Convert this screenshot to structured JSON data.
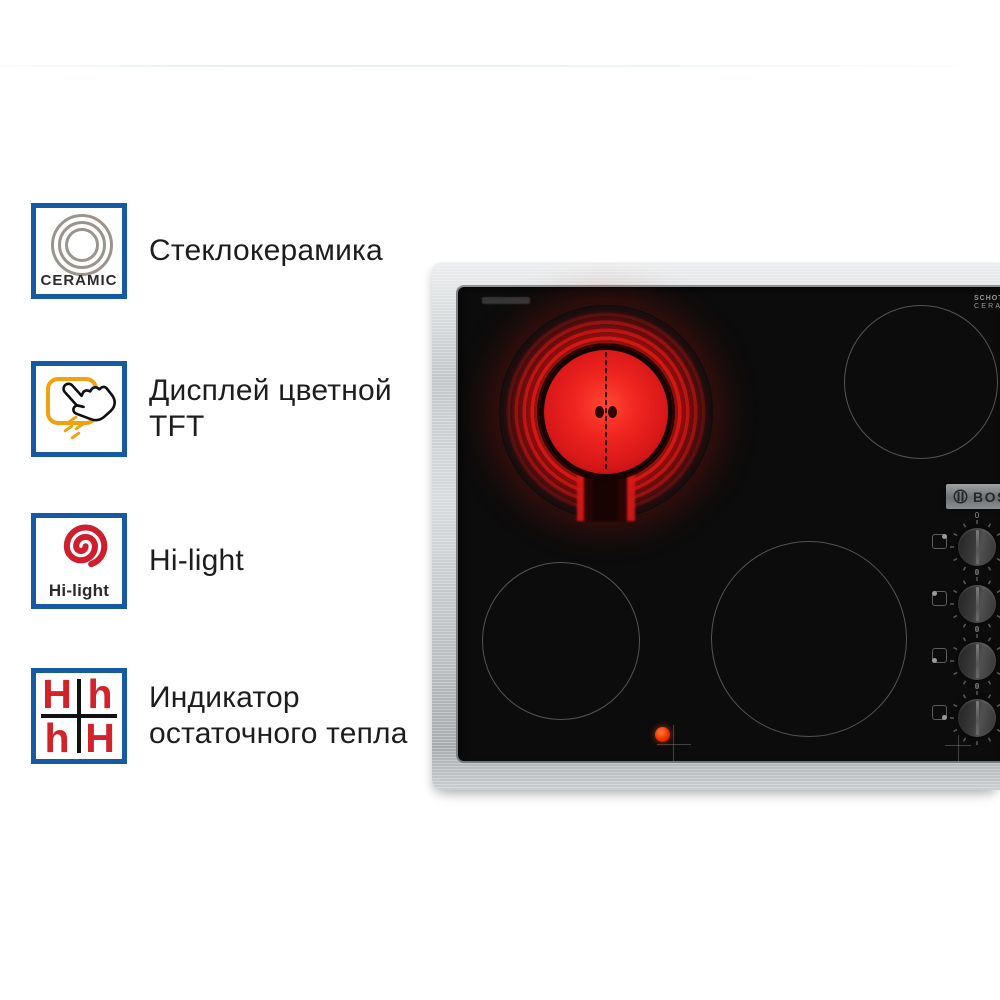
{
  "features": [
    {
      "label": "Стеклокерамика",
      "badge": "CERAMIC",
      "icon": "ceramic-rings-icon"
    },
    {
      "label": "Дисплей цветной TFT",
      "icon": "touch-display-icon"
    },
    {
      "label": "Hi-light",
      "badge": "Hi-light",
      "icon": "hilight-spiral-icon"
    },
    {
      "label": "Индикатор остаточного тепла",
      "icon": "residual-heat-icon",
      "letters": [
        "H",
        "h",
        "h",
        "H"
      ]
    }
  ],
  "cooktop": {
    "brand": "BOSCH",
    "glass_brand": {
      "line1": "SCHOTT",
      "line2": "CERAN®"
    },
    "knob_zero_label": "0",
    "knobs": [
      {
        "zone_dot": "top-right"
      },
      {
        "zone_dot": "top-left"
      },
      {
        "zone_dot": "bottom-left"
      },
      {
        "zone_dot": "bottom-right"
      }
    ],
    "burners": {
      "active": "front-left-glowing",
      "count": 4
    }
  },
  "colors": {
    "accent_blue": "#1659a5",
    "hilight_red": "#cf1f2e",
    "letter_red": "#d2232a",
    "touch_orange": "#f0a10c",
    "glow_red": "#cf1414",
    "steel": "#c3c7c9",
    "glass_black": "#0c0c0c"
  }
}
